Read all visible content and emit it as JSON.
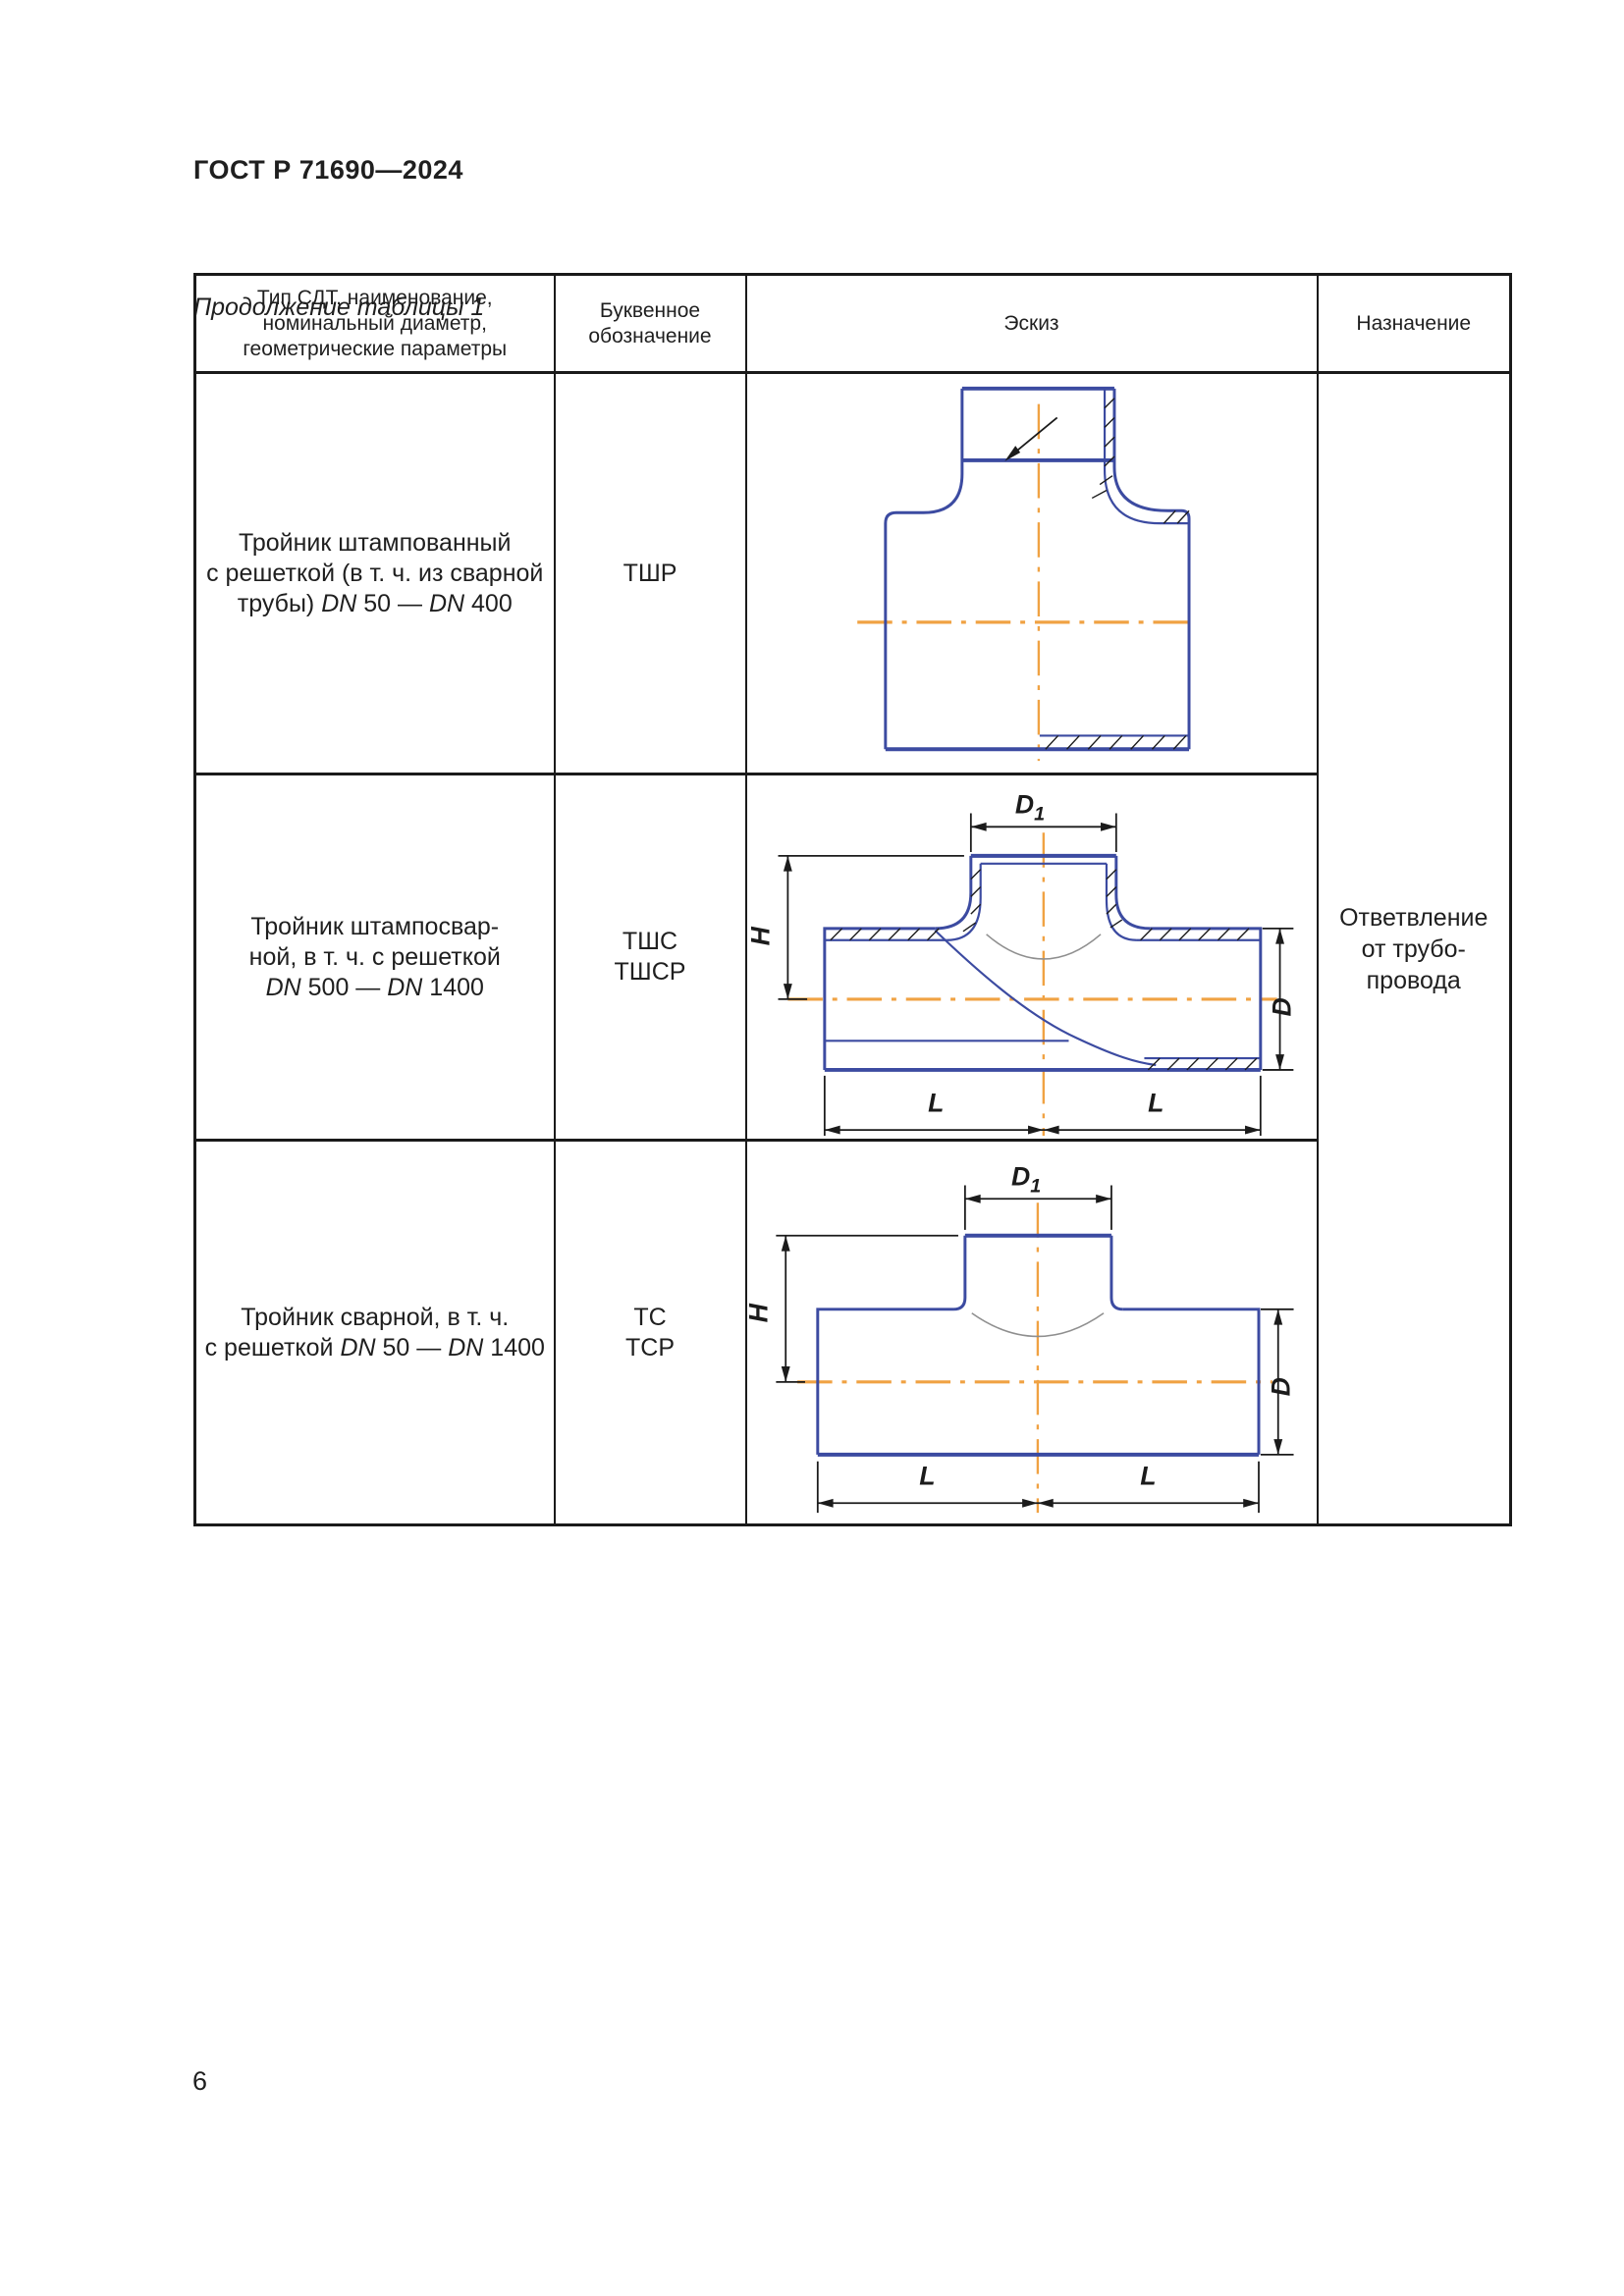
{
  "page": {
    "doc_number": "ГОСТ Р 71690—2024",
    "table_caption": "Продолжение таблицы 1",
    "page_number": "6"
  },
  "colors": {
    "drawing_blue": "#3c4ba1",
    "centerline_orange": "#f0a243",
    "border_black": "#1a1a1a"
  },
  "table": {
    "headers": {
      "type": [
        "Тип СДТ, наименование,",
        "номинальный диаметр,",
        "геометрические параметры"
      ],
      "letter": [
        "Буквенное",
        "обозначение"
      ],
      "sketch": "Эскиз",
      "purpose": "Назначение"
    },
    "rows": [
      {
        "name": [
          [
            "Тройник штампованный"
          ],
          [
            "с решеткой (в т. ч. из сварной"
          ],
          [
            "трубы) ",
            "DN",
            " 50 — ",
            "DN",
            " 400"
          ]
        ],
        "code": [
          "ТШР"
        ]
      },
      {
        "name": [
          [
            "Тройник штампосвар-"
          ],
          [
            "ной, в т. ч. с решеткой"
          ],
          [
            "",
            "DN",
            " 500 — ",
            "DN",
            " 1400"
          ]
        ],
        "code": [
          "ТШС",
          "ТШСР"
        ]
      },
      {
        "name": [
          [
            "Тройник сварной, в т. ч."
          ],
          [
            "с решеткой ",
            "DN",
            " 50 — ",
            "DN",
            " 1400"
          ]
        ],
        "code": [
          "ТС",
          "ТСР"
        ]
      }
    ],
    "purpose_text": [
      "Ответвление",
      "от трубо-",
      "провода"
    ]
  },
  "dims": {
    "d1": "D",
    "d1_sub": "1",
    "h": "H",
    "d": "D",
    "l": "L"
  }
}
